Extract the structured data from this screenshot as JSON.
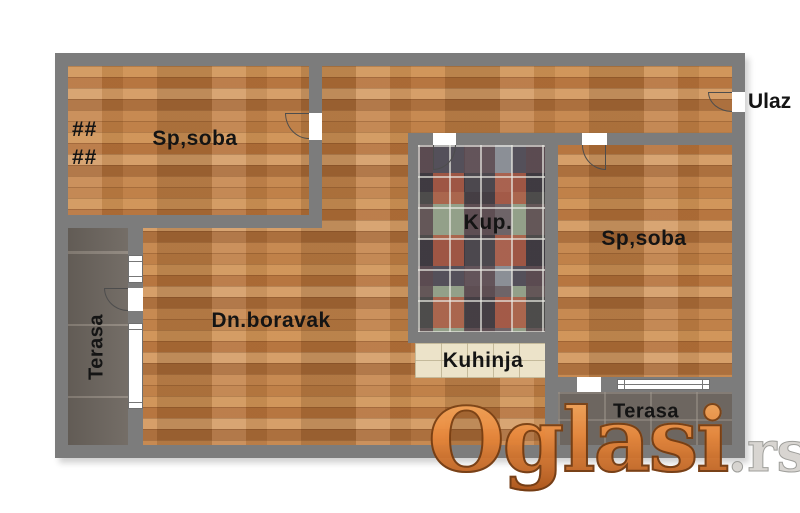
{
  "rooms": {
    "bedroom_left": "Sp,soba",
    "bedroom_right": "Sp,soba",
    "living_room": "Dn.boravak",
    "bathroom": "Kup.",
    "kitchen": "Kuhinja",
    "terrace_left": "Terasa",
    "terrace_right": "Terasa",
    "entrance": "Ulaz"
  },
  "symbols": {
    "radiator_row1": "##",
    "radiator_row2": "##"
  },
  "watermark": {
    "brand": "Oglasi",
    "tld": ".rs"
  },
  "colors": {
    "wall": "#7c7c7c",
    "wood_floor": "#c1874e",
    "terrace_floor": "#6d665f",
    "bath_tile_base": "#88909a",
    "bath_tile_rust": "#b0573f",
    "bath_tile_dark": "#54505a",
    "kitchen_tile": "#ece3c9",
    "label_text": "#141414",
    "watermark_orange": "#ea8a3e",
    "watermark_tld_gray": "#d6d3cf",
    "background": "#ffffff"
  }
}
